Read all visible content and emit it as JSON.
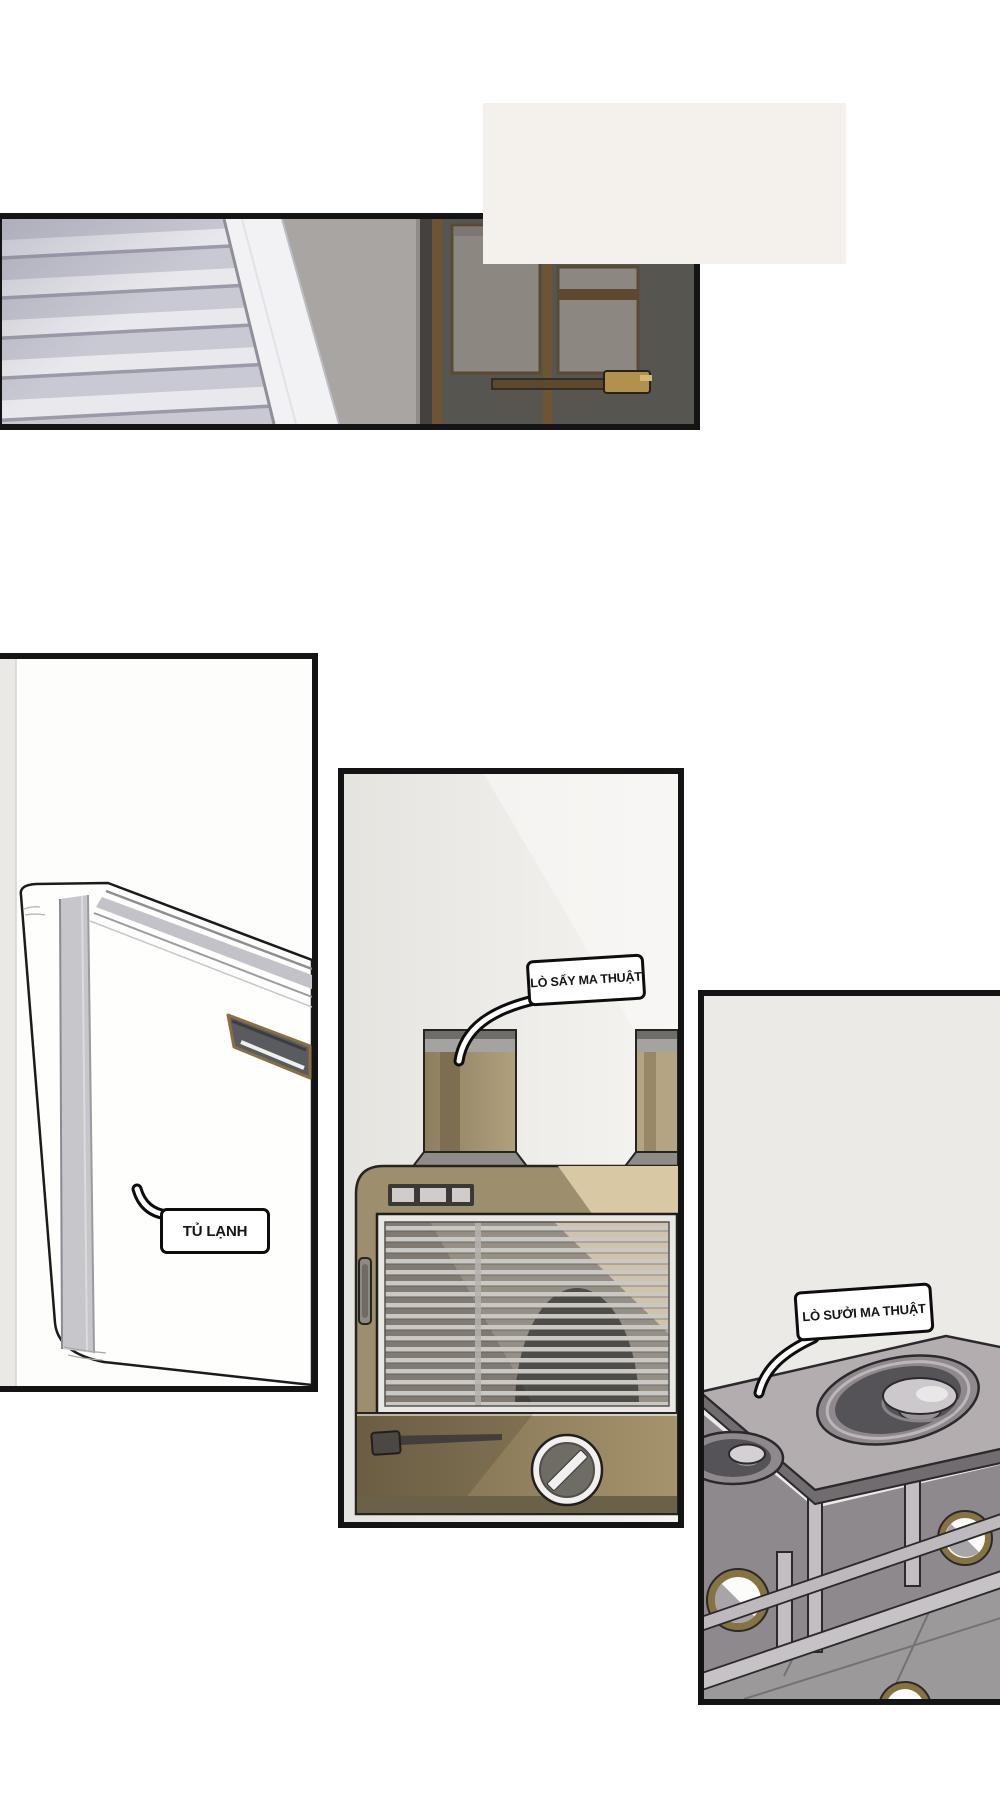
{
  "page": {
    "width": 1000,
    "height": 1803,
    "background": "#ffffff"
  },
  "labels": {
    "fridge": "TỦ LẠNH",
    "dryer": "LÒ SẤY MA THUẬT",
    "heater": "LÒ SƯỞI MA THUẬT"
  },
  "colors": {
    "panel_border": "#141414",
    "caption_box": "#f4f0ec",
    "stairs": "#c9c9d3",
    "banister": "#f2f2f4",
    "wall": "#a8a5a2",
    "door": "#57554f",
    "door_trim": "#6e5433",
    "door_panel": "#8d8781",
    "brass_handle": "#b2914c",
    "fridge_body": "#fefefd",
    "dryer_body": "#9d8e6e",
    "dryer_light": "#d8c9a4",
    "dryer_base": "#7a6b4d",
    "grille_slat": "#cbc8c4",
    "stove_top": "#b4adb0",
    "stove_frame": "#c6c2c5",
    "porthole_ring": "#857342",
    "floor": "#9c999a"
  }
}
